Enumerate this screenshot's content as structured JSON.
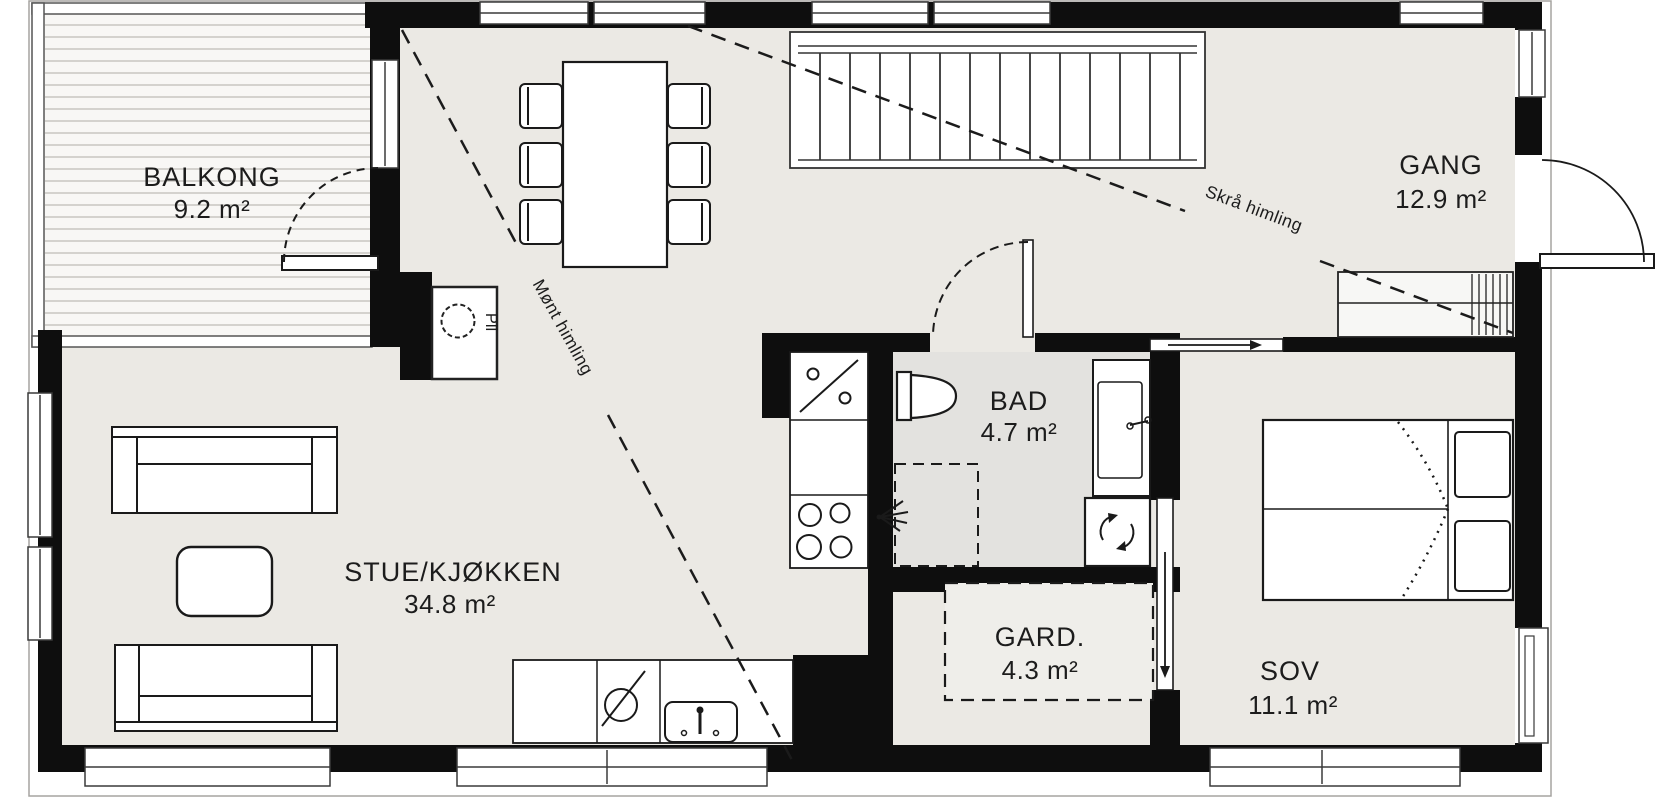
{
  "plan": {
    "type": "floorplan",
    "rooms": {
      "balkong": {
        "name": "BALKONG",
        "area": "9.2 m²"
      },
      "stue_kjokken": {
        "name": "STUE/KJØKKEN",
        "area": "34.8 m²"
      },
      "gang": {
        "name": "GANG",
        "area": "12.9 m²"
      },
      "bad": {
        "name": "BAD",
        "area": "4.7 m²"
      },
      "gard": {
        "name": "GARD.",
        "area": "4.3 m²"
      },
      "sov": {
        "name": "SOV",
        "area": "11.1 m²"
      }
    },
    "annotations": {
      "ridge_ceiling": "Mønt himling",
      "sloped_ceiling": "Skrå himling",
      "pillar_label": "Pll"
    },
    "colors": {
      "wall": "#0e0e0e",
      "floor": "#ebe9e4",
      "bath_floor": "#e3e2df",
      "balcony_deck_line": "#c7c6c2",
      "outline": "#a5a4a0",
      "furniture_stroke": "#1a1a1a",
      "text": "#1c1c1c"
    }
  }
}
